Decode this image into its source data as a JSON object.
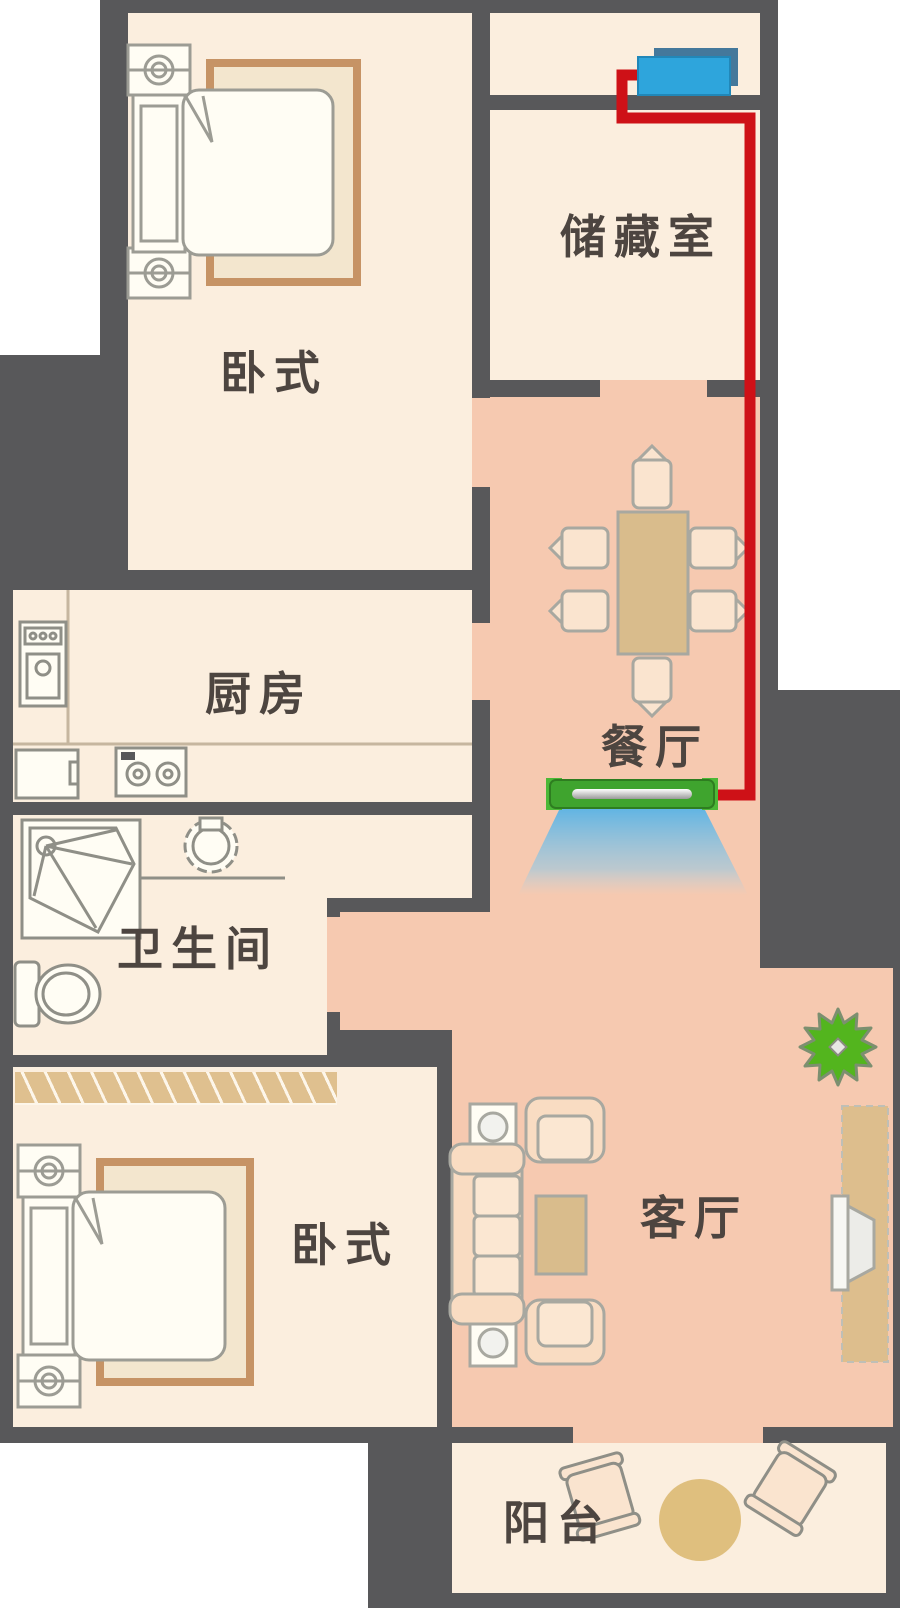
{
  "rooms": [
    {
      "id": "bedroom-top-left",
      "label": "卧式"
    },
    {
      "id": "storage-room",
      "label": "储藏室"
    },
    {
      "id": "kitchen",
      "label": "厨房"
    },
    {
      "id": "dining-room",
      "label": "餐厅"
    },
    {
      "id": "bathroom",
      "label": "卫生间"
    },
    {
      "id": "bedroom-bottom-left",
      "label": "卧式"
    },
    {
      "id": "living-room",
      "label": "客厅"
    },
    {
      "id": "balcony",
      "label": "阳台"
    }
  ],
  "colors": {
    "wall": "#58585A",
    "room_floor": "#FBEEDE",
    "open_area_floor": "#F6C9B0",
    "pipe_red": "#CE1117",
    "outdoor_unit_blue": "#2EA5DC",
    "indoor_unit_green": "#3FA42E",
    "airflow_blue": "#58B3E6",
    "plant_green": "#53B51E",
    "wood_tan": "#D9BC8C"
  },
  "icons": {
    "outdoor-unit-icon": "blue-box",
    "indoor-unit-icon": "green-vent-bar",
    "airflow-icon": "blue-cone",
    "pipe-route-icon": "red-polyline",
    "plant-icon": "green-starburst"
  }
}
